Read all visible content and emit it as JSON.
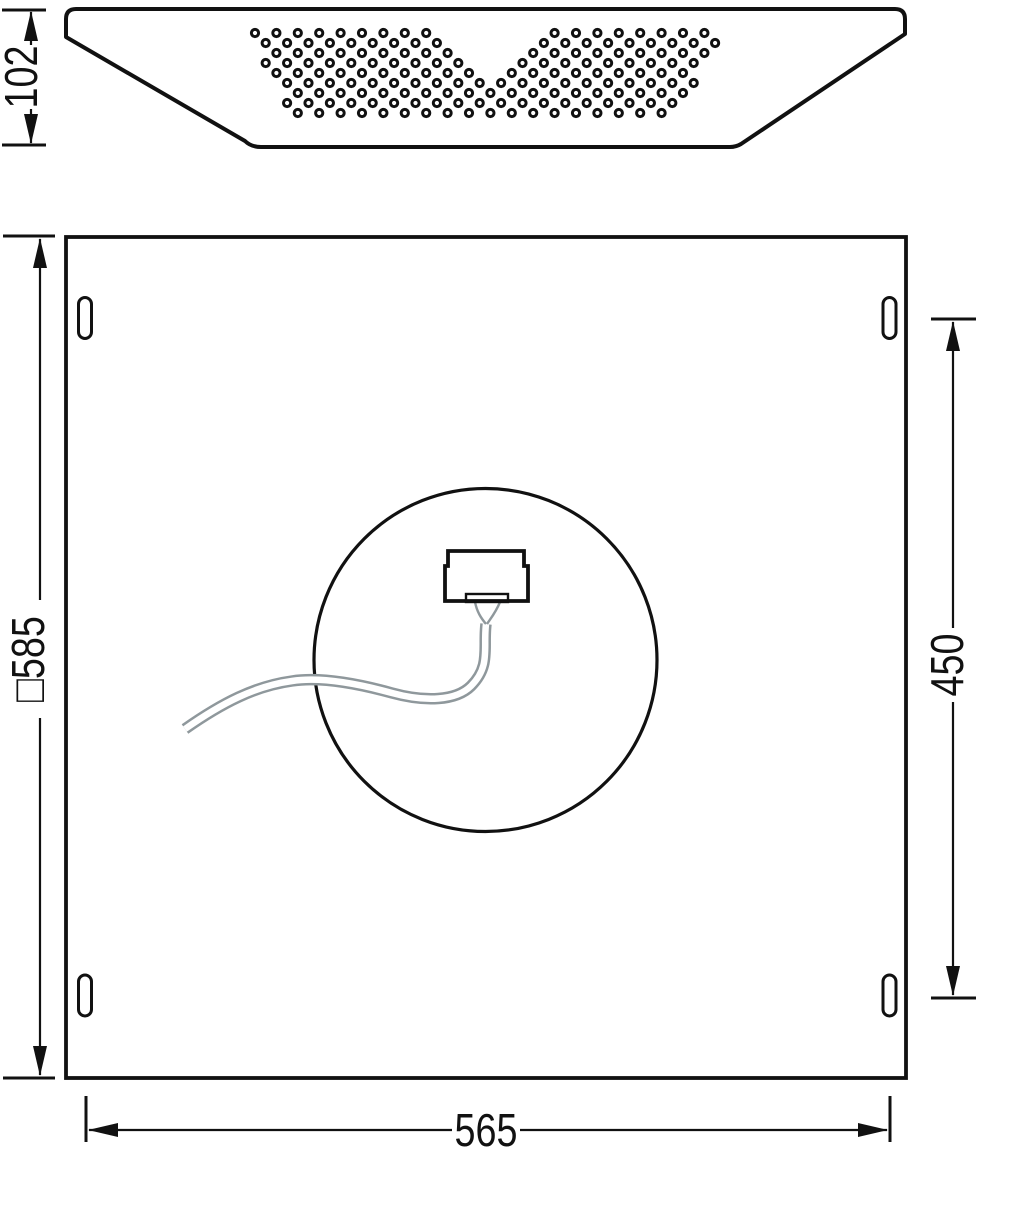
{
  "drawing_title": "Luminaire dimension drawing",
  "colors": {
    "ink": "#111111",
    "cable": "#8f989c",
    "background": "#ffffff"
  },
  "dimensions": {
    "profile_height": {
      "label": "102"
    },
    "panel_square": {
      "label": "□585"
    },
    "mount_vertical": {
      "label": "450"
    },
    "mount_horizontal": {
      "label": "565"
    }
  },
  "top_view": {
    "description": "side profile of recessed panel with perforated diffuser pattern",
    "perforation": {
      "rows": 9,
      "y_start": 33,
      "row_spacing": 10,
      "col_spacing": 21.4,
      "col_base_even": 255,
      "col_base_odd": 244.3,
      "cols_max": 23,
      "left_edge": {
        "base": 246,
        "slope": 0.56
      },
      "right_edge": {
        "base": 720,
        "slope": 0.48
      },
      "notch": {
        "apex_x": 491.5,
        "apex_y": 90,
        "top_y": 27,
        "left_x": 431,
        "right_x": 552
      },
      "hole_radius": 3.6
    }
  },
  "rear_view": {
    "description": "square rear panel with four mounting slots, central knockout circle, connector box and supply cable"
  }
}
